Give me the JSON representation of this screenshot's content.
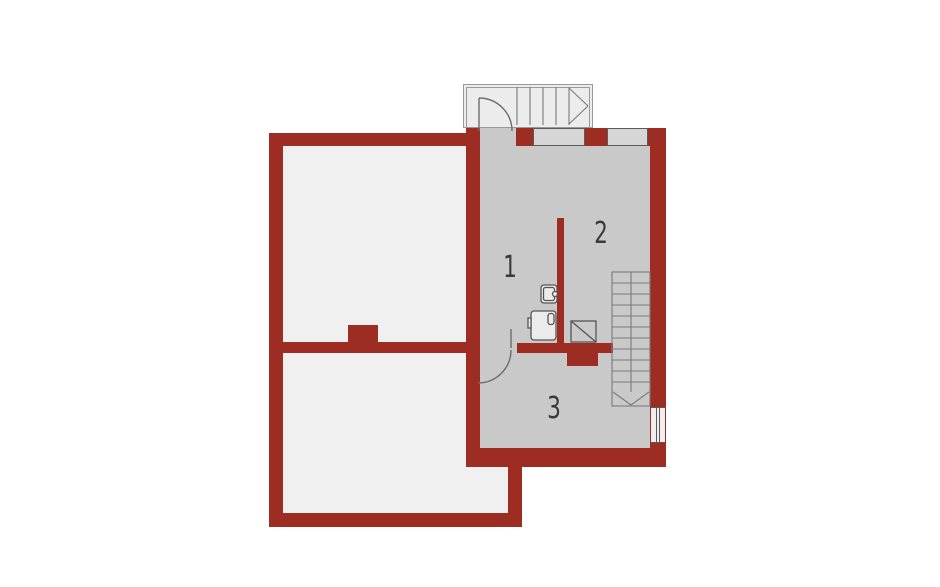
{
  "title": "floor-plan",
  "rooms": [
    {
      "label": "1"
    },
    {
      "label": "2"
    },
    {
      "label": "3"
    }
  ],
  "colors": {
    "background": "#ffffff",
    "wall": "#9d2c23",
    "floor": "#c9c9c9",
    "room": "#f0f0f0",
    "landing": "#ececec",
    "window_h_fill": "#d6d6d6",
    "window_v_fill": "#efefef",
    "outline": "#666666",
    "stair_line": "#7a7a7a",
    "label": "#3a3a3a"
  },
  "icons": {
    "entry_stairs_arrow": "chevron-right",
    "staircase_arrow": "chevron-down",
    "heater_symbol": "square-with-diagonal"
  }
}
